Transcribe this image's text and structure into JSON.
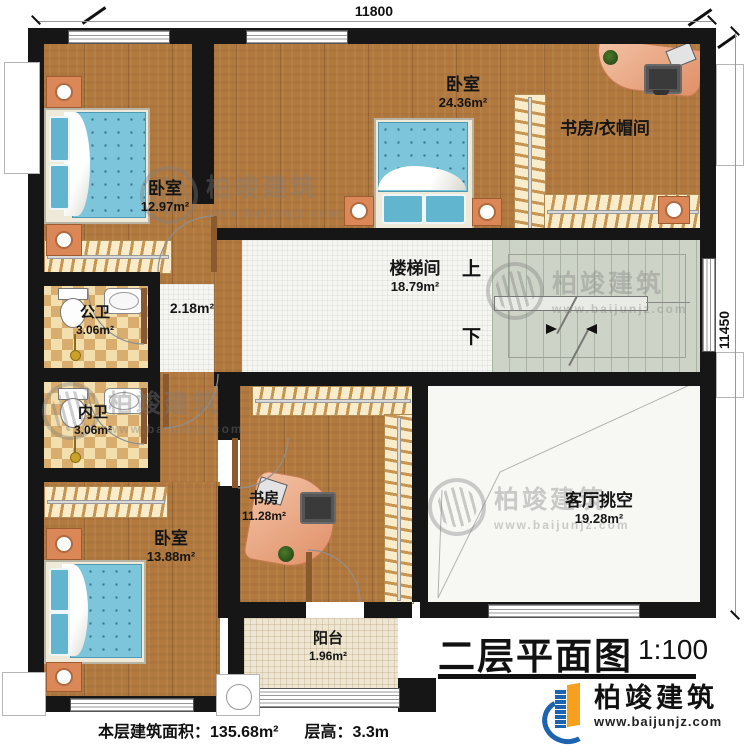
{
  "plan": {
    "title": "二层平面图",
    "scale": "1:100",
    "dimensions": {
      "top": "11800",
      "right": "11450"
    },
    "stats": {
      "area_label": "本层建筑面积：",
      "area_value": "135.68m²",
      "height_label": "层高：",
      "height_value": "3.3m"
    },
    "stairs": {
      "up": "上",
      "down": "下"
    },
    "hallway_area": "2.18m²",
    "rooms": {
      "bedroom_1": {
        "name": "卧室",
        "area": "12.97m²"
      },
      "bedroom_2": {
        "name": "卧室",
        "area": "24.36m²"
      },
      "study_cloakroom": {
        "name": "书房/衣帽间",
        "area": ""
      },
      "stairwell": {
        "name": "楼梯间",
        "area": "18.79m²"
      },
      "public_bathroom": {
        "name": "公卫",
        "area": "3.06m²"
      },
      "inner_bathroom": {
        "name": "内卫",
        "area": "3.06m²"
      },
      "bedroom_3": {
        "name": "卧室",
        "area": "13.88m²"
      },
      "study": {
        "name": "书房",
        "area": "11.28m²"
      },
      "living_void": {
        "name": "客厅挑空",
        "area": "19.28m²"
      },
      "balcony": {
        "name": "阳台",
        "area": "1.96m²"
      }
    }
  },
  "brand": {
    "name": "柏竣建筑",
    "url": "www.baijunjz.com"
  },
  "watermark": {
    "name": "柏竣建筑",
    "url": "www.baijunjz.com"
  },
  "colors": {
    "wall": "#161616",
    "wood_floor": "#b2793f",
    "white_tile": "#f5f5f2",
    "beige_tile": "#eee6d2",
    "bath_checker": "#d9ad6d",
    "stair_green": "#cdd4c7",
    "bed_blue": "#7cc5db",
    "wardrobe_cream": "#f8ecca",
    "desk_salmon": "#e08f66",
    "brand_blue": "#1e63b0",
    "brand_orange": "#f6a01e"
  }
}
